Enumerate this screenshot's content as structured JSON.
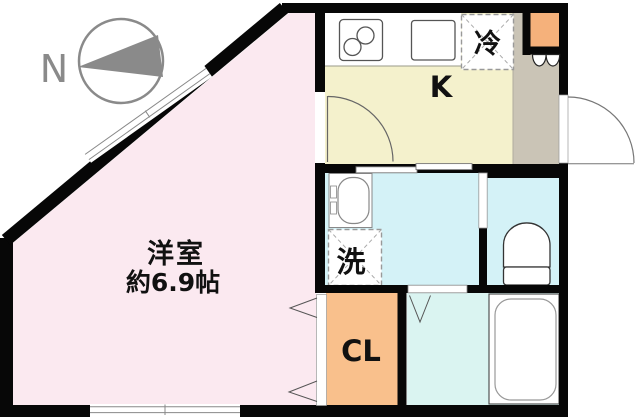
{
  "compass": {
    "label": "N"
  },
  "rooms": {
    "living": {
      "label": "洋室",
      "size": "約6.9帖"
    },
    "kitchen": {
      "label": "K"
    },
    "refrigerator": {
      "label": "冷"
    },
    "washer": {
      "label": "洗"
    },
    "closet": {
      "label": "CL"
    }
  },
  "colors": {
    "wall": "#070707",
    "living_pink": "#fbe9f0",
    "kitchen_yellow": "#f4f1cc",
    "hallway_gray": "#cac4b6",
    "wet_cyan": "#d4f2f7",
    "bath_cyan": "#daf4f1",
    "closet_orange": "#f9c08c",
    "cabinet_orange": "#f5b17b",
    "compass_gray": "#8a8a8a",
    "label_black": "#111111"
  }
}
